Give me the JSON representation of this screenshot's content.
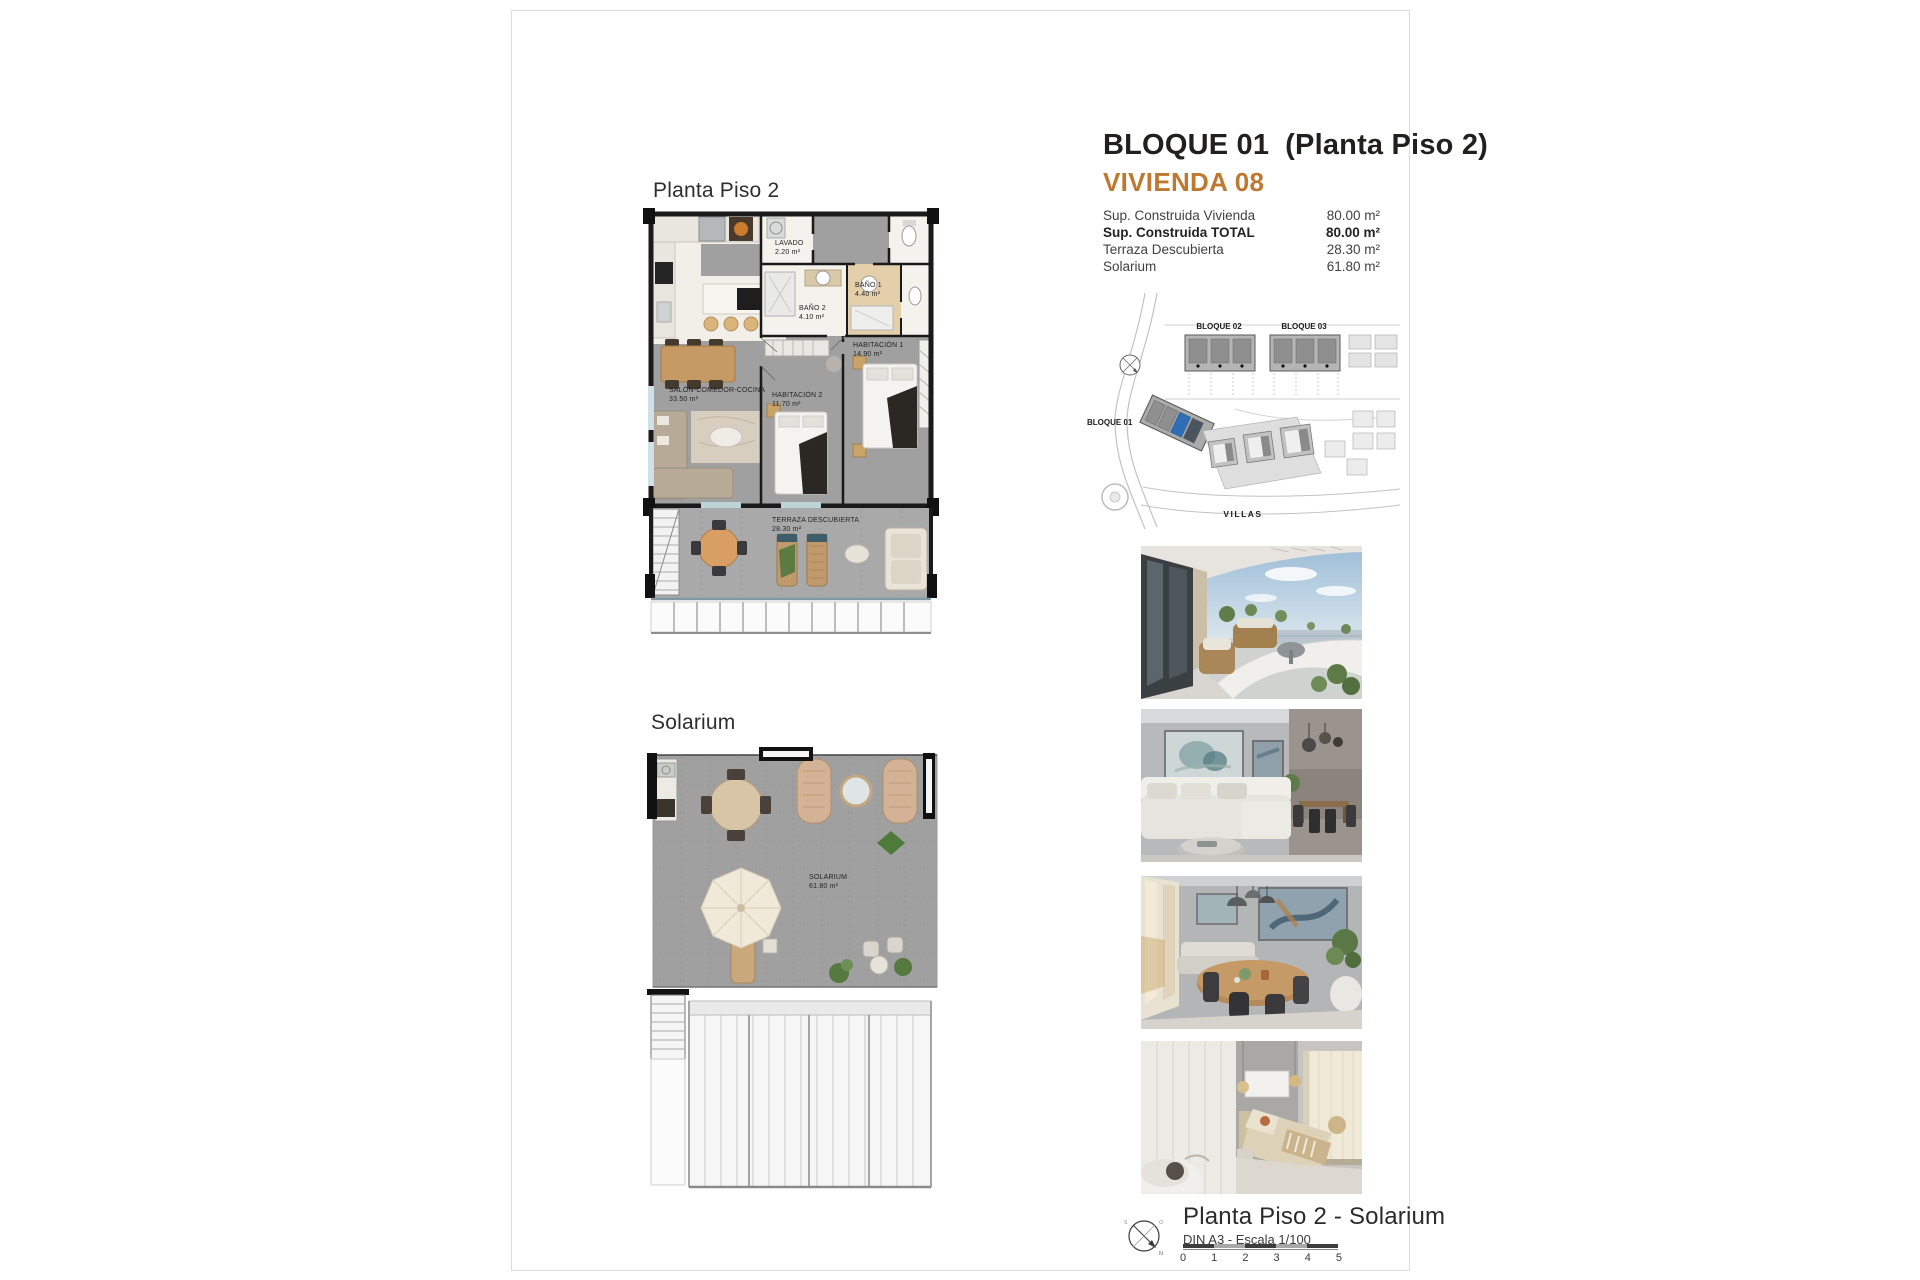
{
  "page": {
    "plan1_title": "Planta Piso 2",
    "plan2_title": "Solarium",
    "accent_color": "#bf7830"
  },
  "header": {
    "block": "BLOQUE 01",
    "floor": "(Planta Piso 2)",
    "unit": "VIVIENDA 08"
  },
  "areas": {
    "rows": [
      {
        "label": "Sup. Construida Vivienda",
        "value": "80.00 m²"
      },
      {
        "label": "Sup. Construida TOTAL",
        "value": "80.00 m²"
      },
      {
        "label": "Terraza Descubierta",
        "value": "28.30 m²"
      },
      {
        "label": "Solarium",
        "value": "61.80 m²"
      }
    ]
  },
  "site_plan": {
    "bloque01": "BLOQUE 01",
    "bloque02": "BLOQUE 02",
    "bloque03": "BLOQUE 03",
    "villas": "VILLAS",
    "highlight_color": "#2f6db5"
  },
  "floor_plan": {
    "rooms": [
      {
        "name": "LAVADO",
        "area": "2.20 m²"
      },
      {
        "name": "BAÑO 2",
        "area": "4.10 m²"
      },
      {
        "name": "BAÑO 1",
        "area": "4.40 m²"
      },
      {
        "name": "HABITACIÓN 1",
        "area": "14.90 m²"
      },
      {
        "name": "HABITACIÓN 2",
        "area": "11.70 m²"
      },
      {
        "name": "SALÓN-COMEDOR-COCINA",
        "area": "33.50 m²"
      },
      {
        "name": "TERRAZA DESCUBIERTA",
        "area": "28.30 m²"
      }
    ]
  },
  "solarium_plan": {
    "name": "SOLARIUM",
    "area": "61.80 m²"
  },
  "photos": [
    {
      "name": "terrace-exterior-render"
    },
    {
      "name": "living-room-render"
    },
    {
      "name": "dining-area-render"
    },
    {
      "name": "bedroom-render"
    }
  ],
  "footer": {
    "title": "Planta Piso 2 - Solarium",
    "scale_note": "DIN A3 - Escala 1/100",
    "ticks": [
      "0",
      "1",
      "2",
      "3",
      "4",
      "5"
    ],
    "compass_letters": {
      "o": "O",
      "s": "S",
      "n": "N"
    }
  }
}
